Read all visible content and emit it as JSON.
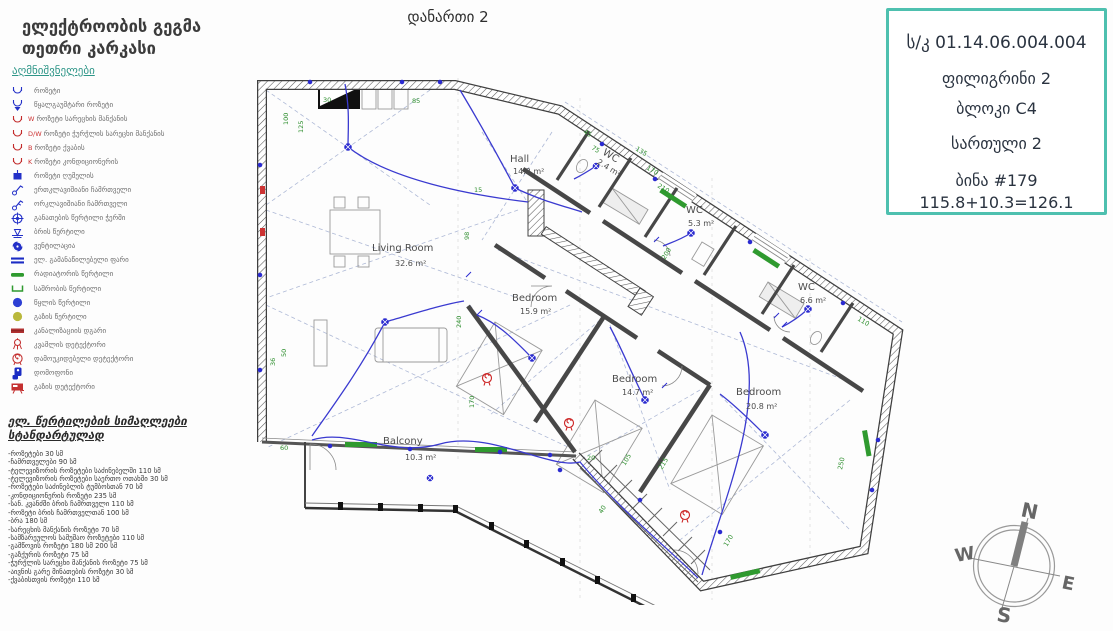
{
  "title": {
    "line1": "ელექტროობის გეგმა",
    "line2": "თეთრი კარკასი"
  },
  "annex": "დანართი 2",
  "legend": {
    "header": "აღმნიშვნელები",
    "items": [
      {
        "icon": "socket-icon",
        "label": "როზეტი"
      },
      {
        "icon": "waterproof-socket-icon",
        "label": "წყალგაუმტარი როზეტი"
      },
      {
        "icon": "washing-machine-socket-icon",
        "suffix": "W",
        "label": "როზეტი სარეცხის მანქანის"
      },
      {
        "icon": "dishwasher-socket-icon",
        "suffix": "D/W",
        "label": "როზეტი ჭურჭლის სარეცხი მანქანის"
      },
      {
        "icon": "boiler-socket-icon",
        "suffix": "B",
        "label": "როზეტი ქვაბის"
      },
      {
        "icon": "ac-socket-icon",
        "suffix": "K",
        "label": "როზეტი კონდიციონერის"
      },
      {
        "icon": "oven-socket-icon",
        "label": "როზეტი ღუმელის"
      },
      {
        "icon": "single-switch-icon",
        "label": "ერთკლავიშიანი ჩამრთველი"
      },
      {
        "icon": "double-switch-icon",
        "label": "ორკლავიშიანი ჩამრთველი"
      },
      {
        "icon": "ceiling-light-icon",
        "label": "განათების წერტილი ჭერში"
      },
      {
        "icon": "sconce-icon",
        "label": "ბრის წერტილი"
      },
      {
        "icon": "ventilation-icon",
        "label": "ვენტილაცია"
      },
      {
        "icon": "distribution-board-icon",
        "label": "ელ. გამანაწილებელი ფარი"
      },
      {
        "icon": "radiator-icon",
        "label": "რადიატორის წერტილი"
      },
      {
        "icon": "towel-dryer-icon",
        "label": "საშრობის წერტილი"
      },
      {
        "icon": "water-point-icon",
        "label": "წყლის წერტილი"
      },
      {
        "icon": "gas-point-icon",
        "label": "გაზის წერტილი"
      },
      {
        "icon": "sewage-riser-icon",
        "label": "კანალიზაციის დგარი"
      },
      {
        "icon": "smoke-detector-icon",
        "label": "კვამლის დეტექტორი"
      },
      {
        "icon": "independent-detector-icon",
        "label": "დამოუკიდებელი დეტექტორი"
      },
      {
        "icon": "intercom-icon",
        "label": "დომოფონი"
      },
      {
        "icon": "gas-detector-icon",
        "label": "გაზის დეტექტორი"
      }
    ]
  },
  "standards": {
    "header_line1": "ელ. წერტილების სიმაღლეები",
    "header_line2": "სტანდარტულად",
    "items": [
      "-როზეტები 30 სმ",
      "-ჩამრთველები 90 სმ",
      "-ტელევიზორის როზეტები საძინებელში 110 სმ",
      "-ტელევიზორის როზეტები საერთო ოთახში 30 სმ",
      "-როზეტები საძინებლის ტუმბოსთან 70 სმ",
      "-კონდიციონერის როზეტი 235 სმ",
      "-სან. კვანძში ბრის ჩამრთველი 110 სმ",
      "-როზეტი ბრის ჩამრთველთან 100 სმ",
      "-ბრა 180 სმ",
      "-სარეცხის მანქანის როზეტი 70 სმ",
      "-სამზარეულოს სამუშაო როზეტები 110 სმ",
      "-გამწოვის როზეტი 180 სმ 200 სმ",
      "-გაზქურის როზეტი 75 სმ",
      "-ჭურჭლის სარეცხი მანქანის როზეტი 75 სმ",
      "-აივნის გარე მინათების როზეტი 30 სმ",
      "-ქვაბისთვის როზეტი 110 სმ"
    ]
  },
  "info_box": {
    "cadastral": "ს/კ 01.14.06.004.004",
    "project": "ფილიგრინი 2",
    "block": "ბლოკი C4",
    "floor": "სართული 2",
    "apartment": "ბინა #179",
    "area_sum": "115.8+10.3=126.1",
    "border_color": "#4ec0af"
  },
  "plan": {
    "rooms": [
      {
        "name": "Hall",
        "area": "14.2 m²"
      },
      {
        "name": "Living Room",
        "area": "32.6 m²"
      },
      {
        "name": "Bedroom",
        "area": "15.9 m²"
      },
      {
        "name": "Bedroom",
        "area": "14.7 m²"
      },
      {
        "name": "Bedroom",
        "area": "20.8 m²"
      },
      {
        "name": "WC",
        "area": "2.4 m²"
      },
      {
        "name": "WC",
        "area": "5.3 m²"
      },
      {
        "name": "WC",
        "area": "6.6 m²"
      },
      {
        "name": "Balcony",
        "area": "10.3 m²"
      }
    ],
    "dimensions": [
      "30",
      "85",
      "100",
      "125",
      "15",
      "50",
      "36",
      "98",
      "240",
      "170",
      "60",
      "135",
      "170",
      "210",
      "45",
      "75",
      "200",
      "105",
      "215",
      "20",
      "40",
      "170",
      "250",
      "110"
    ],
    "colors": {
      "wiring": "#3a3ad0",
      "dimension": "#2f8f2f",
      "detector": "#cc2222",
      "wall": "#3f3f3f"
    }
  },
  "compass": {
    "labels": {
      "n": "N",
      "w": "W",
      "e": "E",
      "s": "S"
    }
  }
}
